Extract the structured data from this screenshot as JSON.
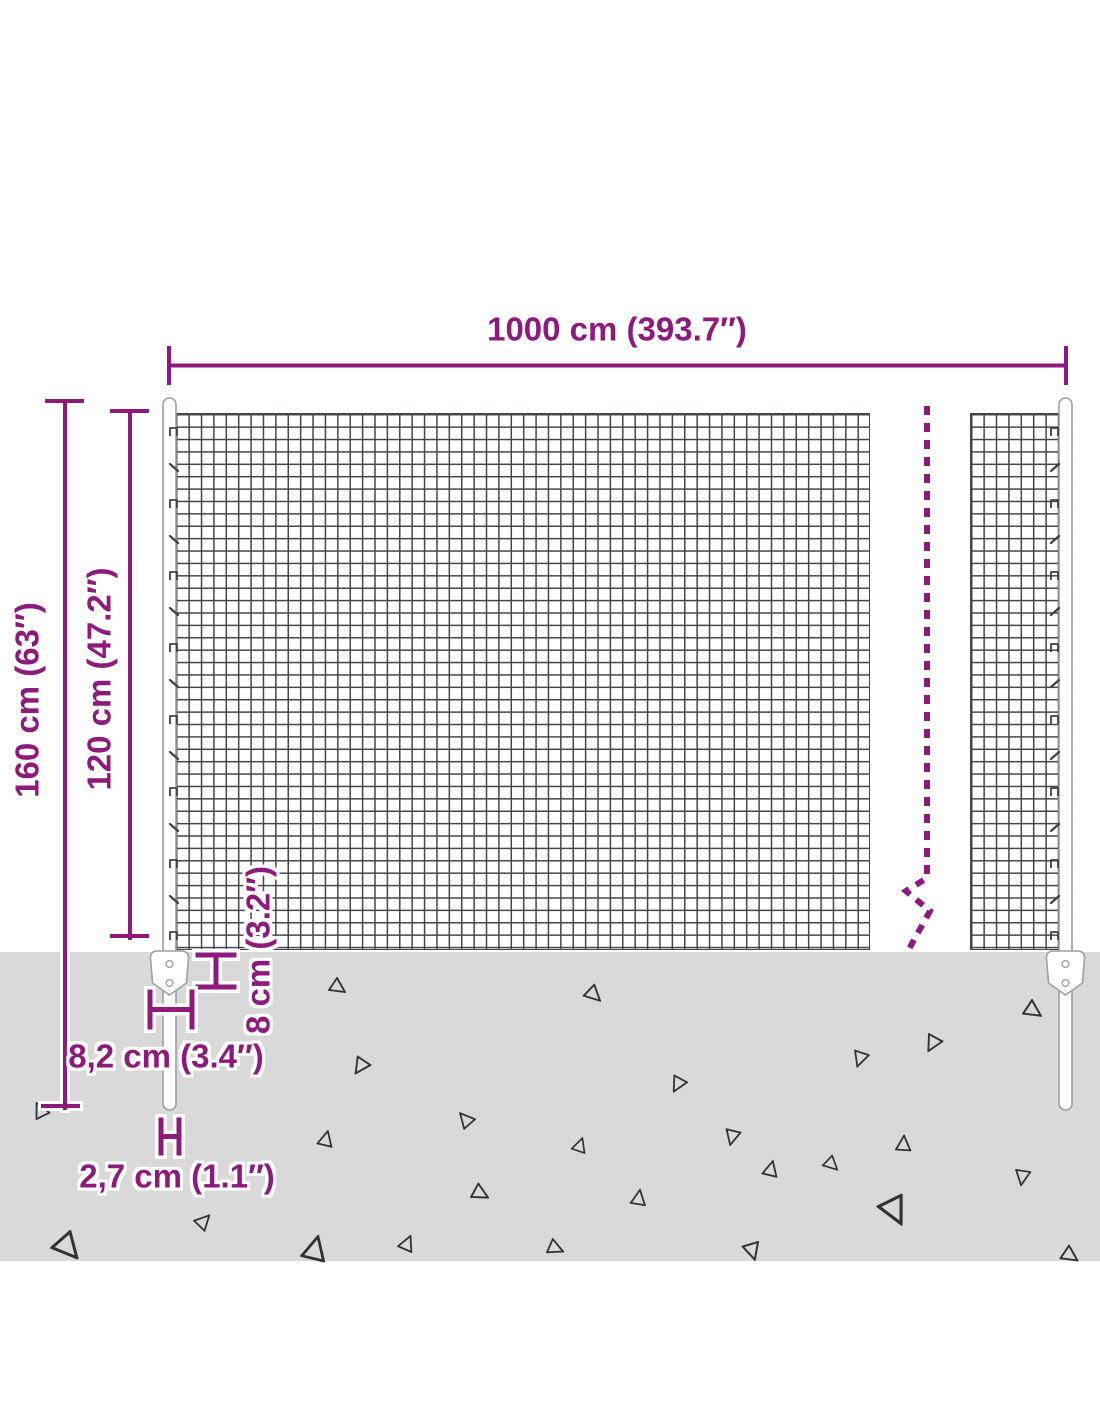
{
  "dims": {
    "width": {
      "label": "1000 cm (393.7″)"
    },
    "total_height": {
      "label": "160 cm (63″)"
    },
    "mesh_height": {
      "label": "120 cm (47.2″)"
    },
    "anchor_depth": {
      "label": "8 cm (3.2″)"
    },
    "anchor_width": {
      "label": "8,2 cm (3.4″)"
    },
    "post_diameter": {
      "label": "2,7 cm (1.1″)"
    }
  },
  "colors": {
    "accent": "#8e1a7c",
    "ground": "#d9d9d9",
    "wire": "#43474c",
    "post_outline": "#9aa0a5",
    "triangle": "#2f3338"
  },
  "ground": {
    "triangles": [
      [
        40,
        1113,
        18,
        210
      ],
      [
        337,
        985,
        18,
        0
      ],
      [
        593,
        992,
        19,
        10
      ],
      [
        1032,
        1008,
        20,
        0
      ],
      [
        935,
        1042,
        19,
        85
      ],
      [
        862,
        1057,
        18,
        75
      ],
      [
        363,
        1065,
        19,
        90
      ],
      [
        680,
        1083,
        18,
        85
      ],
      [
        466,
        1122,
        18,
        195
      ],
      [
        734,
        1135,
        18,
        70
      ],
      [
        578,
        1147,
        17,
        255
      ],
      [
        902,
        1146,
        18,
        240
      ],
      [
        324,
        1141,
        18,
        250
      ],
      [
        831,
        1162,
        17,
        10
      ],
      [
        1024,
        1175,
        18,
        65
      ],
      [
        769,
        1171,
        18,
        250
      ],
      [
        479,
        1191,
        19,
        355
      ],
      [
        637,
        1200,
        18,
        245
      ],
      [
        895,
        1206,
        32,
        30
      ],
      [
        753,
        1248,
        20,
        40
      ],
      [
        67,
        1243,
        30,
        15
      ],
      [
        201,
        1222,
        18,
        280
      ],
      [
        312,
        1252,
        28,
        250
      ],
      [
        405,
        1245,
        18,
        260
      ],
      [
        554,
        1246,
        18,
        350
      ],
      [
        1069,
        1253,
        19,
        0
      ]
    ]
  },
  "clips": {
    "start_y": 428,
    "step": 36,
    "count": 15,
    "left_x": 170,
    "right_x": 1051
  }
}
